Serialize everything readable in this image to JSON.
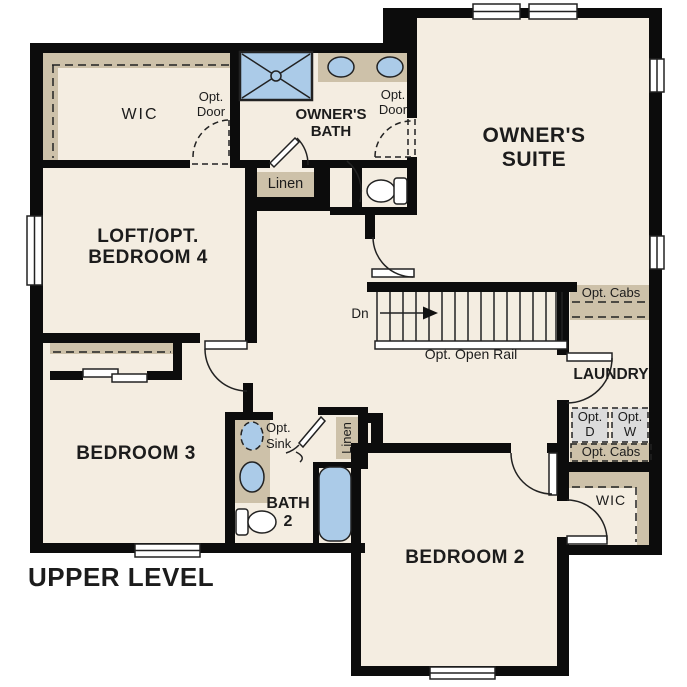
{
  "level_title": "UPPER LEVEL",
  "rooms": {
    "owners_suite": {
      "line1": "OWNER'S",
      "line2": "SUITE"
    },
    "owners_bath": {
      "line1": "OWNER'S",
      "line2": "BATH"
    },
    "wic_owner": {
      "label": "WIC"
    },
    "loft": {
      "line1": "LOFT/OPT.",
      "line2": "BEDROOM 4"
    },
    "bedroom3": {
      "label": "BEDROOM 3"
    },
    "bedroom2": {
      "label": "BEDROOM 2"
    },
    "bath2": {
      "line1": "BATH",
      "line2": "2"
    },
    "laundry": {
      "label": "LAUNDRY"
    },
    "wic_bedroom2": {
      "label": "WIC"
    }
  },
  "features": {
    "opt_door_wic": {
      "line1": "Opt.",
      "line2": "Door"
    },
    "opt_door_suite": {
      "line1": "Opt.",
      "line2": "Door"
    },
    "linen_owners_bath": {
      "label": "Linen"
    },
    "linen_bath2": {
      "label": "Linen"
    },
    "stairs": {
      "down_label": "Dn",
      "rail_label": "Opt. Open Rail"
    },
    "opt_cabs_upper": {
      "label": "Opt. Cabs"
    },
    "opt_cabs_lower": {
      "label": "Opt. Cabs"
    },
    "opt_dryer": {
      "line1": "Opt.",
      "line2": "D"
    },
    "opt_washer": {
      "line1": "Opt.",
      "line2": "W"
    },
    "opt_sink": {
      "line1": "Opt.",
      "line2": "Sink"
    }
  },
  "colors": {
    "background": "#ffffff",
    "floor": "#f4ede1",
    "wall": "#0c0c0c",
    "cabinetry_tan": "#cdc1a9",
    "fixture_blue": "#abcbe8",
    "optional_appliance_gray": "#dcdcdc"
  }
}
